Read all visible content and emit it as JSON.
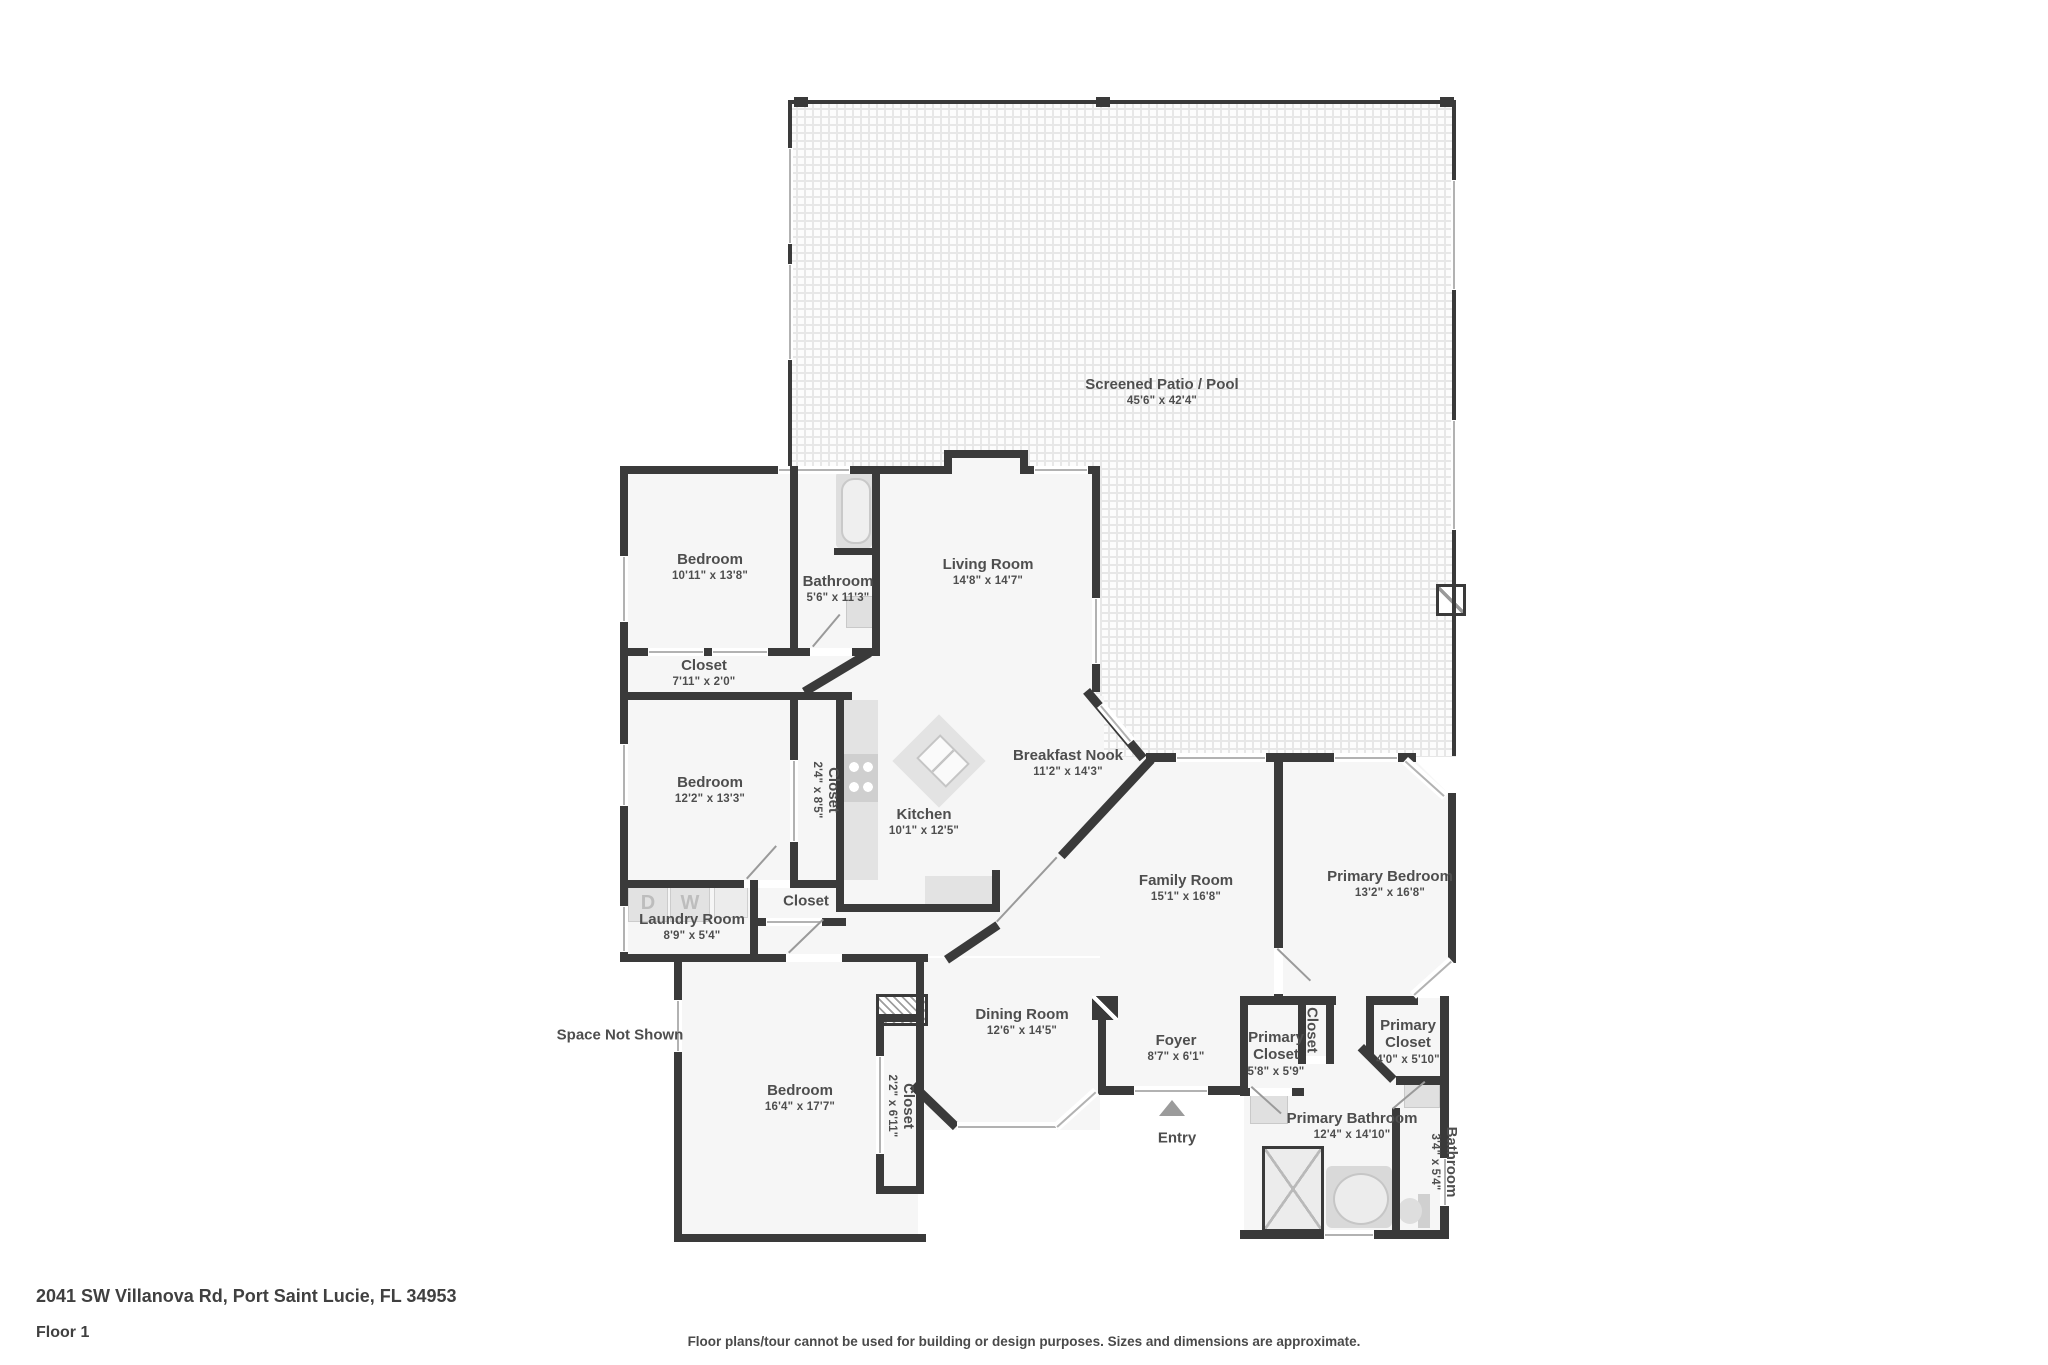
{
  "page": {
    "address": "2041 SW Villanova Rd, Port Saint Lucie, FL 34953",
    "floor_label": "Floor 1",
    "disclaimer": "Floor plans/tour cannot be used for building or design purposes. Sizes and dimensions are approximate."
  },
  "colors": {
    "wall": "#3a3a3a",
    "room_fill": "#f6f6f6",
    "fixture_fill": "#e2e2e2",
    "text": "#4e4e4e"
  },
  "rooms": [
    {
      "name": "Screened Patio / Pool",
      "dims": "45'6\" x 42'4\""
    },
    {
      "name": "Bedroom",
      "dims": "10'11\" x 13'8\""
    },
    {
      "name": "Bathroom",
      "dims": "5'6\" x 11'3\""
    },
    {
      "name": "Living Room",
      "dims": "14'8\" x 14'7\""
    },
    {
      "name": "Closet",
      "dims": "7'11\" x 2'0\""
    },
    {
      "name": "Bedroom",
      "dims": "12'2\" x 13'3\""
    },
    {
      "name": "Closet",
      "dims": "2'4\" x 8'5\""
    },
    {
      "name": "Kitchen",
      "dims": "10'1\" x 12'5\""
    },
    {
      "name": "Breakfast Nook",
      "dims": "11'2\" x 14'3\""
    },
    {
      "name": "Family Room",
      "dims": "15'1\" x 16'8\""
    },
    {
      "name": "Primary Bedroom",
      "dims": "13'2\" x 16'8\""
    },
    {
      "name": "Laundry Room",
      "dims": "8'9\" x 5'4\""
    },
    {
      "name": "Closet",
      "dims": ""
    },
    {
      "name": "Bedroom",
      "dims": "16'4\" x 17'7\""
    },
    {
      "name": "Closet",
      "dims": "2'2\" x 6'11\""
    },
    {
      "name": "Dining Room",
      "dims": "12'6\" x 14'5\""
    },
    {
      "name": "Foyer",
      "dims": "8'7\" x 6'1\""
    },
    {
      "name": "Primary Closet",
      "dims": "5'8\" x 5'9\""
    },
    {
      "name": "Closet",
      "dims": ""
    },
    {
      "name": "Primary Closet",
      "dims": "4'0\" x 5'10\""
    },
    {
      "name": "Primary Bathroom",
      "dims": "12'4\" x 14'10\""
    },
    {
      "name": "Bathroom",
      "dims": "3'4\" x 5'4\""
    }
  ],
  "annotations": {
    "space_not_shown": "Space Not Shown",
    "entry": "Entry"
  },
  "laundry": {
    "dryer_label": "D",
    "washer_label": "W"
  }
}
